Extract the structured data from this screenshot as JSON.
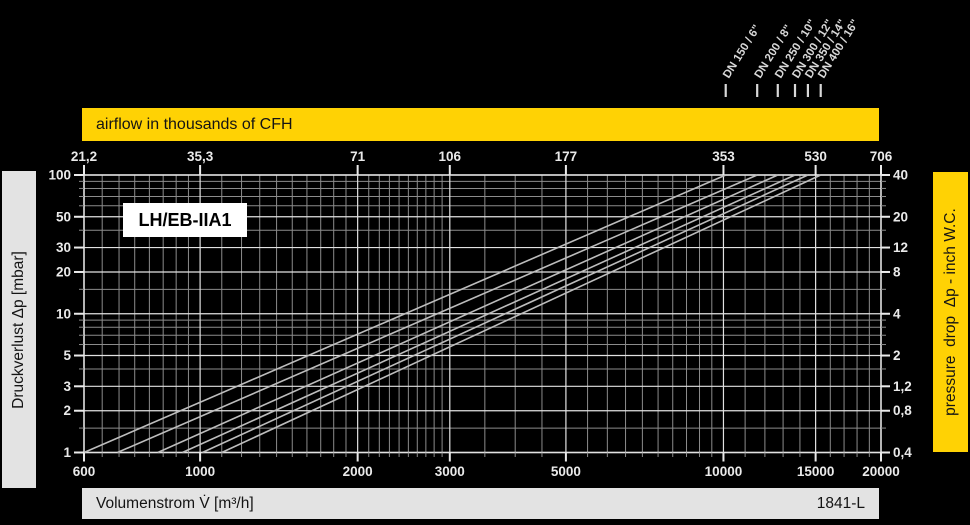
{
  "meta": {
    "model_label": "LH/EB-IIA1",
    "doc_ref": "1841-L"
  },
  "colors": {
    "background": "#000000",
    "yellow": "#FFD204",
    "gray_bar": "#E3E3E3",
    "grid_minor": "#8C8C8C",
    "grid_major": "#E2E2E2",
    "curve": "#BDBDBD",
    "axis_text": "#EAEAEA",
    "dn_text": "#D8D8D8",
    "box_bg": "#FFFFFF"
  },
  "banners": {
    "top": "airflow in thousands of CFH",
    "left": "Druckverlust Δp [mbar]",
    "right": "pressure  drop  Δp - inch W.C.",
    "bottom": "Volumenstrom V̇ [m³/h]"
  },
  "chart_data": {
    "type": "line",
    "title": "LH/EB-IIA1",
    "x_scale": "log",
    "y_scale": "log",
    "x_axis_bottom": {
      "label": "Volumenstrom V̇ [m³/h]",
      "range": [
        600,
        20000
      ],
      "labeled_ticks": [
        600,
        1000,
        2000,
        3000,
        5000,
        10000,
        15000,
        20000
      ],
      "minor_ticks": [
        650,
        700,
        750,
        800,
        850,
        900,
        950,
        1100,
        1200,
        1300,
        1400,
        1500,
        1600,
        1700,
        1800,
        1900,
        2100,
        2200,
        2300,
        2400,
        2500,
        2600,
        2700,
        2800,
        2900,
        3500,
        4000,
        4500,
        5500,
        6000,
        6500,
        7000,
        7500,
        8000,
        8500,
        9000,
        9500,
        11000,
        12000,
        13000,
        14000,
        16000,
        17000,
        18000,
        19000
      ]
    },
    "x_axis_top": {
      "label": "airflow in thousands of CFH",
      "tick_labels": [
        "21,2",
        "35,3",
        "71",
        "106",
        "177",
        "353",
        "530",
        "706"
      ],
      "tick_positions_m3h": [
        600,
        1000,
        2000,
        3000,
        5000,
        10000,
        15000,
        20000
      ]
    },
    "y_axis_left": {
      "label": "Druckverlust Δp [mbar]",
      "range": [
        1,
        100
      ],
      "labeled_ticks": [
        100,
        50,
        30,
        20,
        10,
        5,
        3,
        2,
        1
      ],
      "minor_ticks": [
        1.5,
        4,
        6,
        7,
        8,
        9,
        15,
        40,
        60,
        70,
        80,
        90
      ]
    },
    "y_axis_right": {
      "label": "pressure drop Δp - inch W.C.",
      "tick_labels": [
        "40",
        "20",
        "12",
        "8",
        "4",
        "2",
        "1,2",
        "0,8",
        "0,4"
      ],
      "tick_positions_mbar": [
        100,
        50,
        30,
        20,
        10,
        5,
        3,
        2,
        1
      ]
    },
    "series": [
      {
        "name": "DN 150 / 6\"",
        "flow_m3h_at_1_mbar": 600,
        "flow_m3h_at_100_mbar": 10100
      },
      {
        "name": "DN 200 / 8\"",
        "flow_m3h_at_1_mbar": 695,
        "flow_m3h_at_100_mbar": 11600
      },
      {
        "name": "DN 250 / 10\"",
        "flow_m3h_at_1_mbar": 830,
        "flow_m3h_at_100_mbar": 12700
      },
      {
        "name": "DN 300 / 12\"",
        "flow_m3h_at_1_mbar": 925,
        "flow_m3h_at_100_mbar": 13700
      },
      {
        "name": "DN 350 / 14\"",
        "flow_m3h_at_1_mbar": 1010,
        "flow_m3h_at_100_mbar": 14500
      },
      {
        "name": "DN 400 / 16\"",
        "flow_m3h_at_1_mbar": 1100,
        "flow_m3h_at_100_mbar": 15340
      }
    ]
  }
}
